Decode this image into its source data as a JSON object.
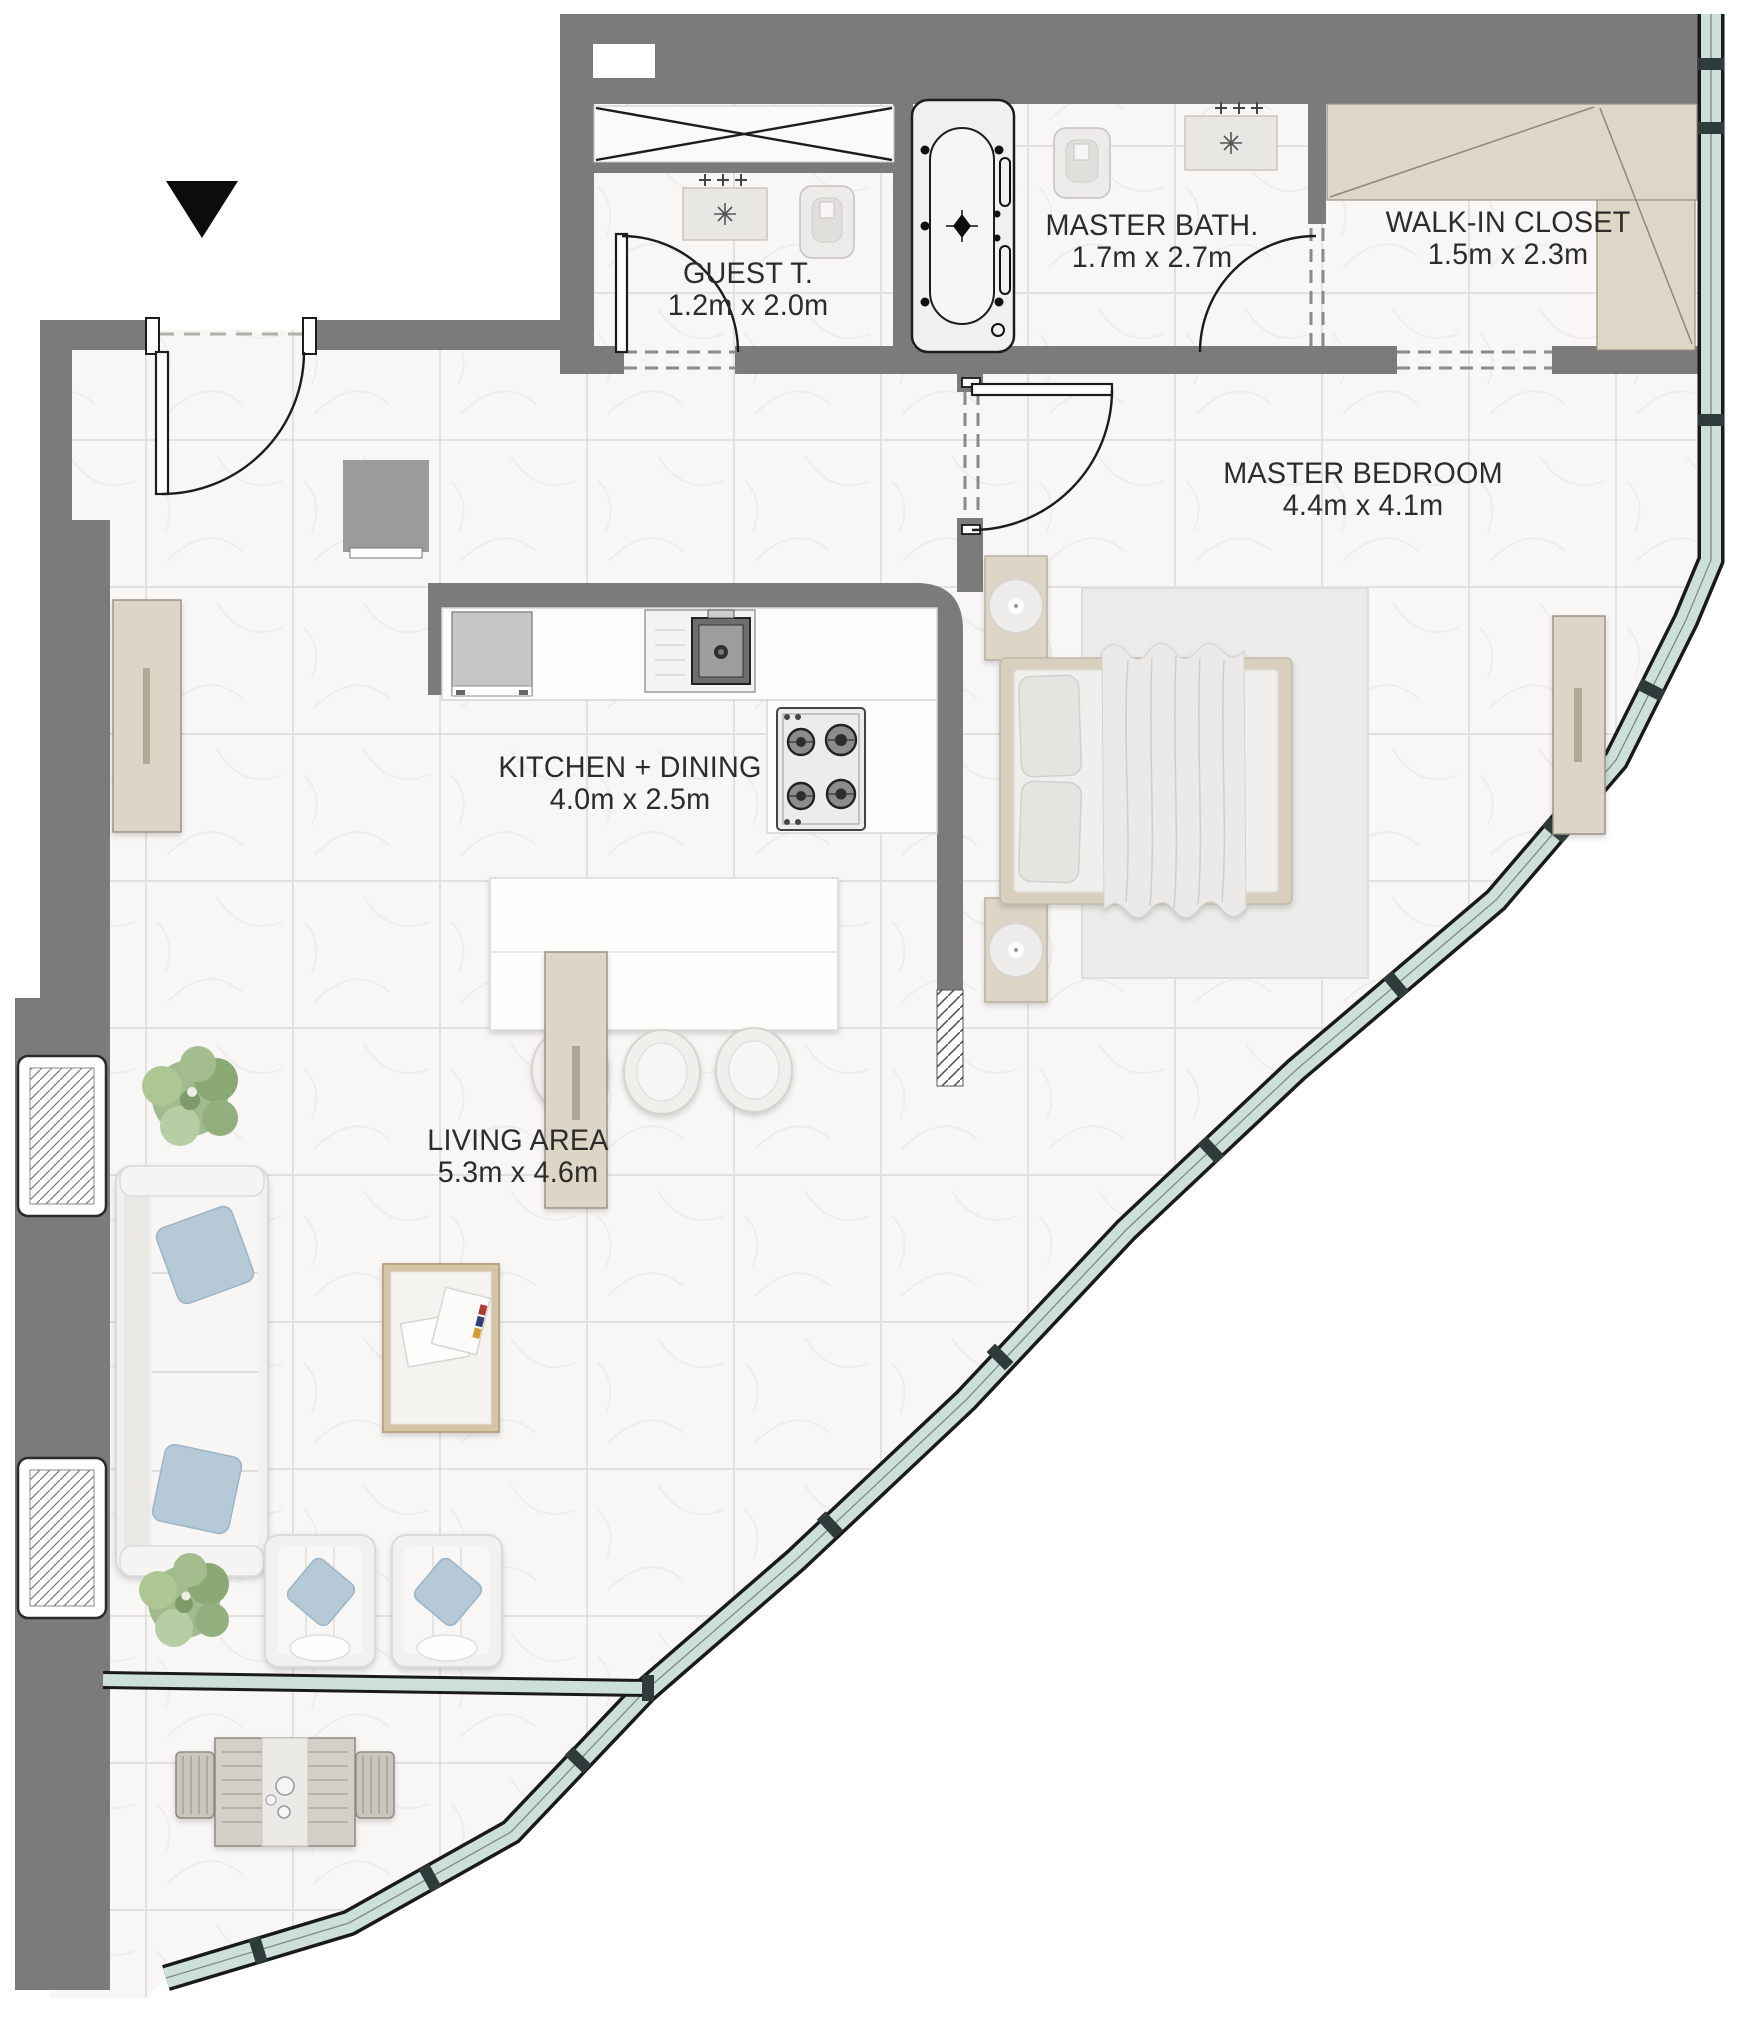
{
  "plan": {
    "type": "apartment-floor-plan",
    "rooms": [
      {
        "id": "guest-toilet",
        "name": "GUEST T.",
        "dims": "1.2m x 2.0m"
      },
      {
        "id": "master-bath",
        "name": "MASTER BATH.",
        "dims": "1.7m x 2.7m"
      },
      {
        "id": "walk-in-closet",
        "name": "WALK-IN CLOSET",
        "dims": "1.5m x 2.3m"
      },
      {
        "id": "master-bedroom",
        "name": "MASTER BEDROOM",
        "dims": "4.4m x 4.1m"
      },
      {
        "id": "kitchen-dining",
        "name": "KITCHEN + DINING",
        "dims": "4.0m x 2.5m"
      },
      {
        "id": "living-area",
        "name": "LIVING AREA",
        "dims": "5.3m x 4.6m"
      }
    ],
    "icons": {
      "entry_marker": "triangle-down"
    },
    "colors": {
      "wall": "#7b7b7b",
      "floor": "#f8f7f5",
      "glass": "#cddfd9",
      "wood": "#ded6c6",
      "pillow": "#b5c9d6",
      "plant": "#9cb788",
      "line": "#1c1c1c"
    }
  }
}
